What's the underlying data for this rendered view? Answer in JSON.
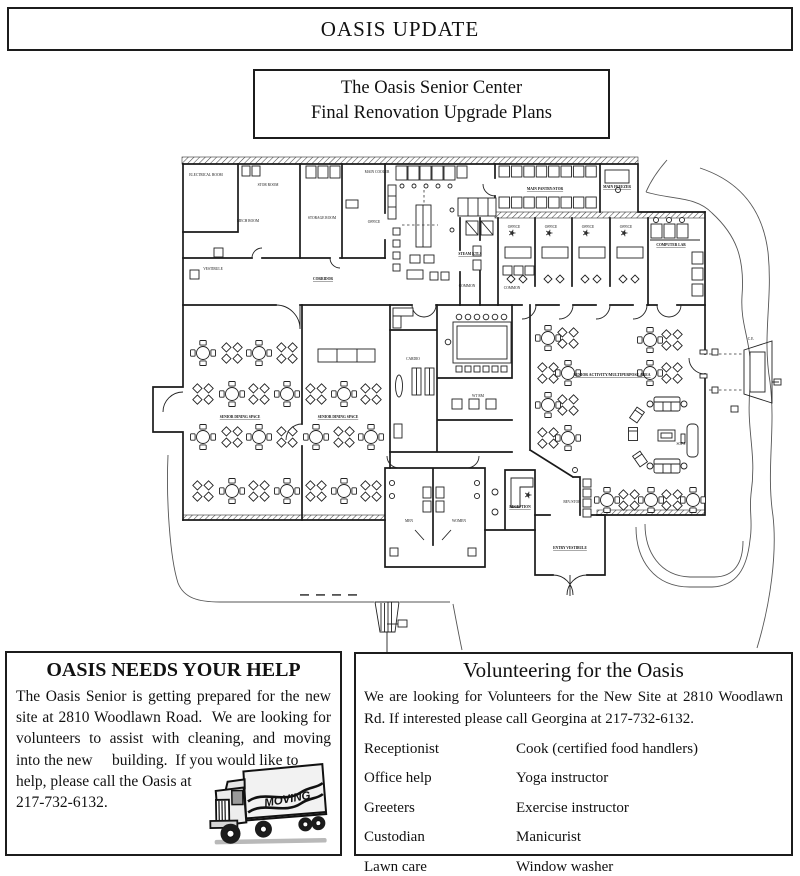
{
  "header": {
    "title": "OASIS UPDATE"
  },
  "plan_title": {
    "line1": "The Oasis Senior Center",
    "line2": "Final Renovation Upgrade Plans"
  },
  "floor_plan": {
    "labels": [
      {
        "text": "ELECTRICAL ROOM",
        "x": 206,
        "y": 176
      },
      {
        "text": "STOR ROOM",
        "x": 268,
        "y": 186
      },
      {
        "text": "MECH ROOM",
        "x": 248,
        "y": 222
      },
      {
        "text": "STORAGE ROOM",
        "x": 322,
        "y": 219
      },
      {
        "text": "MAIN COOLER",
        "x": 377,
        "y": 173
      },
      {
        "text": "OFFICE",
        "x": 374,
        "y": 223
      },
      {
        "text": "MAIN PANTRY/STOR",
        "x": 545,
        "y": 190,
        "ul": true
      },
      {
        "text": "MAIN FREEZER",
        "x": 617,
        "y": 188,
        "ul": true
      },
      {
        "text": "VESTIBULE",
        "x": 213,
        "y": 270
      },
      {
        "text": "CORRIDOR",
        "x": 323,
        "y": 280,
        "ul": true
      },
      {
        "text": "STEAM KTLS",
        "x": 470,
        "y": 255,
        "ul": true
      },
      {
        "text": "COMMON",
        "x": 467,
        "y": 287
      },
      {
        "text": "COMMON",
        "x": 512,
        "y": 289
      },
      {
        "text": "OFFICE",
        "x": 514,
        "y": 228
      },
      {
        "text": "OFFICE",
        "x": 551,
        "y": 228
      },
      {
        "text": "OFFICE",
        "x": 588,
        "y": 228
      },
      {
        "text": "OFFICE",
        "x": 626,
        "y": 228
      },
      {
        "text": "COMPUTER LAB",
        "x": 671,
        "y": 246,
        "ul": true
      },
      {
        "text": "SENIOR DINING SPACE",
        "x": 240,
        "y": 418,
        "ul": true
      },
      {
        "text": "SENIOR DINING SPACE",
        "x": 338,
        "y": 418,
        "ul": true
      },
      {
        "text": "SENIOR ACTIVITY/MULTIPURPOSE AREA",
        "x": 612,
        "y": 376,
        "ul": true,
        "fs": 3.8
      },
      {
        "text": "WT RM",
        "x": 478,
        "y": 397
      },
      {
        "text": "CARDIO",
        "x": 413,
        "y": 360
      },
      {
        "text": "RECEPTION",
        "x": 520,
        "y": 508,
        "ul": true
      },
      {
        "text": "BEV/STOR",
        "x": 572,
        "y": 503
      },
      {
        "text": "MEN",
        "x": 409,
        "y": 522
      },
      {
        "text": "WOMEN",
        "x": 459,
        "y": 522
      },
      {
        "text": "ENTRY VESTIBULE",
        "x": 570,
        "y": 549,
        "ul": true
      },
      {
        "text": "SOFA",
        "x": 681,
        "y": 445
      },
      {
        "text": "C.E.",
        "x": 751,
        "y": 340
      }
    ]
  },
  "help_box": {
    "title": "OASIS NEEDS YOUR HELP",
    "body_main": "The Oasis Senior is getting prepared for the new site at 2810 Woodlawn Road.  We are looking for volunteers to assist with cleaning, and moving into the new     building.  If you would like to",
    "body_tail": "help, please call the Oasis at 217-732-6132.",
    "truck_label": "MOVING"
  },
  "volunteer_box": {
    "title": "Volunteering for the Oasis",
    "intro": "We are looking for Volunteers for the New Site at 2810 Woodlawn Rd. If interested please call Georgina at 217‑732‑6132.",
    "roles_left": [
      "Receptionist",
      "Office help",
      "Greeters",
      "Custodian",
      "Lawn care"
    ],
    "roles_right": [
      "Cook (certified food handlers)",
      "Yoga instructor",
      "Exercise instructor",
      "Manicurist",
      "Window washer"
    ]
  }
}
